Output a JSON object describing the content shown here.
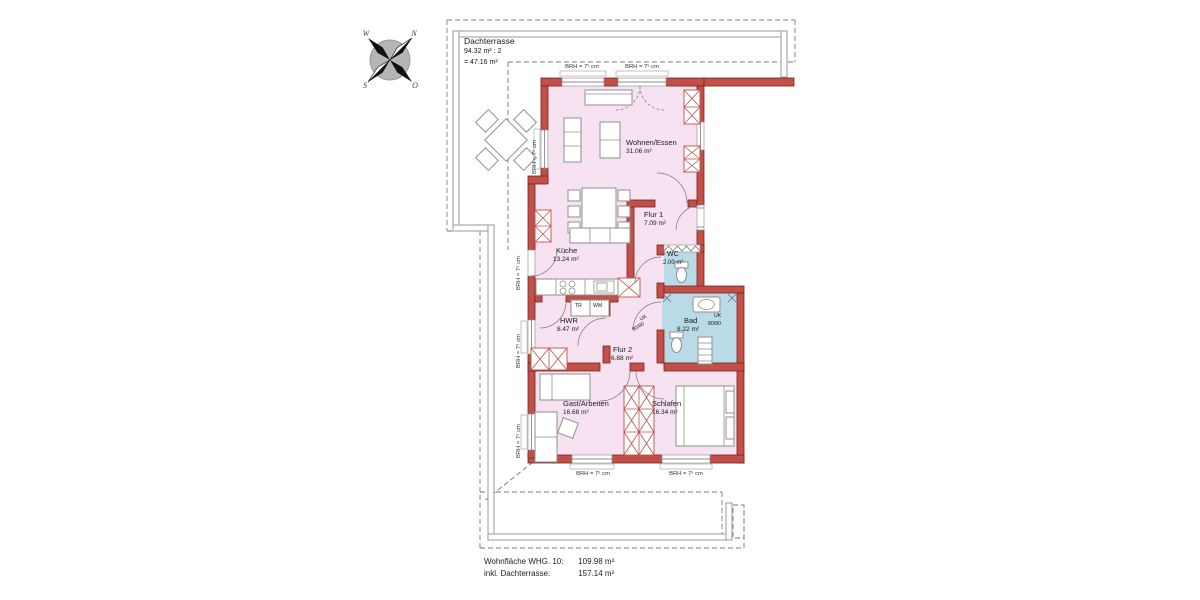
{
  "terrace": {
    "name": "Dachterrasse",
    "calc": "94.32 m² : 2",
    "result": "= 47.16 m²"
  },
  "rooms": {
    "wohnen_essen": {
      "name": "Wohnen/Essen",
      "area": "31.06 m²"
    },
    "flur1": {
      "name": "Flur 1",
      "area": "7.09 m²"
    },
    "wc": {
      "name": "WC",
      "area": "2.00 m²"
    },
    "kueche": {
      "name": "Küche",
      "area": "13.24 m²"
    },
    "hwr": {
      "name": "HWR",
      "area": "8.47 m²"
    },
    "flur2": {
      "name": "Flur 2",
      "area": "6.88 m²"
    },
    "bad": {
      "name": "Bad",
      "area": "8.22 m²"
    },
    "gast_arbeiten": {
      "name": "Gast/Arbeiten",
      "area": "16.68 m²"
    },
    "schlafen": {
      "name": "Schlafen",
      "area": "16.34 m²"
    }
  },
  "annotations": {
    "brh": "BRH = 7⁵ cm",
    "uk": "UK",
    "uk_size": "80/80",
    "tr": "TR",
    "wm": "WM"
  },
  "compass": {
    "n": "N",
    "o": "O",
    "s": "S",
    "w": "W"
  },
  "footer": {
    "line1_label": "Wohnfläche WHG. 10:",
    "line1_value": "109.98 m²",
    "line2_label": "inkl. Dachterrasse:",
    "line2_value": "157.14 m²"
  },
  "colors": {
    "wall": "#c05048",
    "wall-edge": "#7d1f1a",
    "room-fill": "#f6e2f0",
    "wet-fill": "#b9dbe7",
    "line-gray": "#9a9a9a"
  }
}
